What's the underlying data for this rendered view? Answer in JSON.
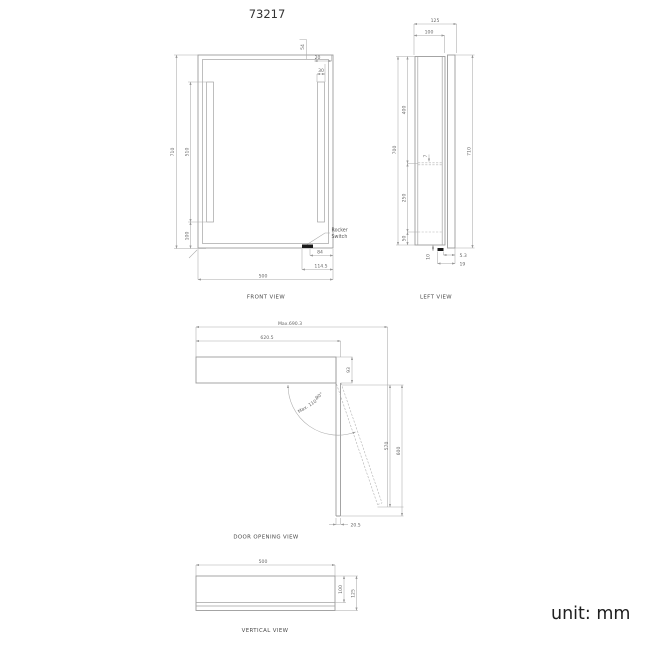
{
  "title": "73217",
  "unit_label": "unit: mm",
  "colors": {
    "line": "#9b9b9b",
    "dim_text": "#666666",
    "title_text": "#333333",
    "unit_text": "#1f1f1f",
    "switch_fill": "#1a1a1a",
    "background": "#ffffff"
  },
  "views": {
    "front": {
      "label": "FRONT VIEW",
      "dims": {
        "height": "710",
        "led_height": "510",
        "bottom_gap": "100",
        "top_offset": "54",
        "side_gap": "20",
        "led_width": "30",
        "switch_to_edge": "84",
        "switch_offset": "114.5",
        "width": "500"
      },
      "annotations": {
        "rocker_switch_line1": "Rocker",
        "rocker_switch_line2": "Switch"
      }
    },
    "left": {
      "label": "LEFT VIEW",
      "dims": {
        "depth_total": "125",
        "depth_body": "100",
        "body_height": "700",
        "door_height": "710",
        "shelf_top": "400",
        "shelf_thickness": "7",
        "shelf_spacing": "250",
        "bottom_offset": "50",
        "switch_height": "10",
        "switch_protrusion": "5.3",
        "switch_length": "19"
      }
    },
    "door": {
      "label": "DOOR  OPENING  VIEW",
      "dims": {
        "max_reach": "Max.690.3",
        "open_reach": "620.5",
        "body_depth": "93",
        "angle_90": "90°",
        "angle_max": "Max. 110°",
        "door_extent": "570",
        "door_total_extent": "600",
        "door_thickness": "20.5"
      }
    },
    "vertical": {
      "label": "VERTICAL VIEW",
      "dims": {
        "width": "500",
        "depth_body": "100",
        "depth_total": "125"
      }
    }
  }
}
